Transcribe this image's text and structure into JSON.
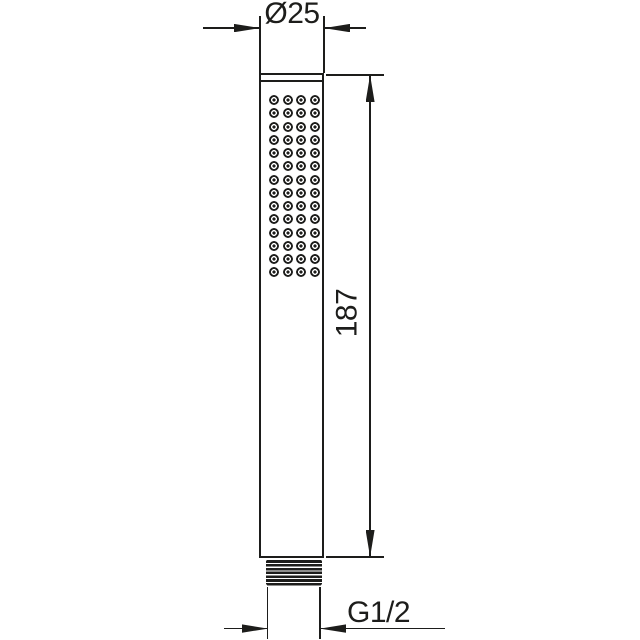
{
  "diagram": {
    "type": "technical-drawing",
    "labels": {
      "diameter": "Ø25",
      "height": "187",
      "thread": "G1/2"
    },
    "nozzles": {
      "rows": 14,
      "cols": 4,
      "dot_size_px": 10
    },
    "colors": {
      "line": "#1d1d1b",
      "background": "#ffffff"
    }
  }
}
